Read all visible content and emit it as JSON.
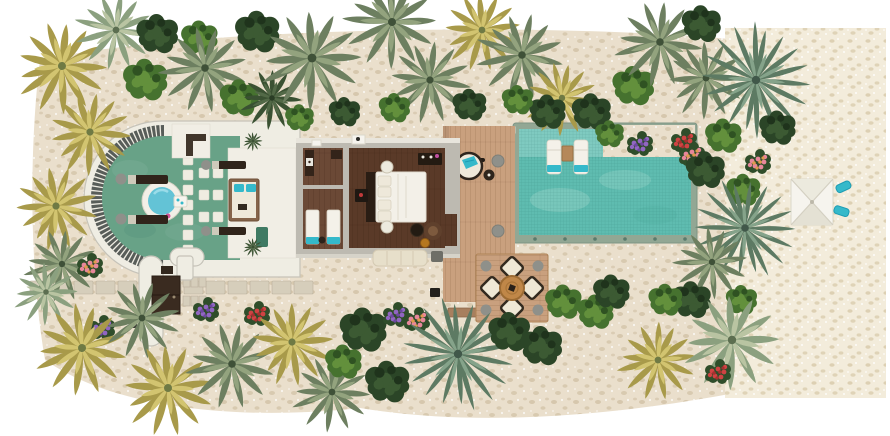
{
  "meta": {
    "view": "villa-floor-plan-top-down",
    "canvas": {
      "width": 890,
      "height": 436
    }
  },
  "colors": {
    "sand": "#eadfcc",
    "beach": "#f3ecdb",
    "paver": "#d6cebb",
    "paverLine": "#b9b09b",
    "wallWhite": "#efede3",
    "wallGray": "#bdbab1",
    "wallLine": "#c6c3b9",
    "floorWhite": "#f1eee5",
    "stoneWhite": "#efece1",
    "slat": "#585d59",
    "pond": "#68a287",
    "jacuzzi": "#63c3d6",
    "jacuzziRim": "#f2efe7",
    "woodDark": "#5a3a28",
    "woodMid": "#6b4936",
    "deck": "#c9a07e",
    "coping": "#92a794",
    "poolMain": "#5fbcb0",
    "poolShelf": "#7fcac0",
    "teal": "#35b9ca",
    "loungerWhite": "#f4f1e9",
    "cream": "#efe8d5",
    "darkFurn": "#241b12",
    "brown": "#5f402c",
    "amber": "#b5771f",
    "red": "#c03a3a",
    "gray": "#8f908a",
    "white": "#f6f4ee"
  },
  "scene": {
    "variants": {
      "palm": {
        "kind": "star",
        "outer": 12,
        "inner": 8,
        "rOuter": 46,
        "rInner": 29,
        "wOuter": 4.6,
        "wInner": 3.4,
        "colors": [
          "#6d7f60",
          "#93a37e",
          "#3f5138"
        ]
      },
      "palmLight": {
        "kind": "star",
        "outer": 12,
        "inner": 8,
        "rOuter": 46,
        "rInner": 29,
        "wOuter": 4.6,
        "wInner": 3.4,
        "colors": [
          "#8ba07f",
          "#b9c4a2",
          "#5c6e50"
        ]
      },
      "palmGold": {
        "kind": "star",
        "outer": 13,
        "inner": 9,
        "rOuter": 46,
        "rInner": 28,
        "wOuter": 4.8,
        "wInner": 3.4,
        "colors": [
          "#a89a4a",
          "#d2c470",
          "#6f7a44"
        ]
      },
      "palmDark": {
        "kind": "star",
        "outer": 12,
        "inner": 8,
        "rOuter": 44,
        "rInner": 27,
        "wOuter": 4.6,
        "wInner": 3.2,
        "colors": [
          "#3a5132",
          "#526947",
          "#2a3d25"
        ]
      },
      "fan": {
        "kind": "star",
        "outer": 18,
        "inner": 10,
        "rOuter": 52,
        "rInner": 30,
        "wOuter": 3.2,
        "wInner": 2.4,
        "colors": [
          "#5d7a63",
          "#85a38a",
          "#41584a"
        ]
      },
      "bush": {
        "kind": "cluster",
        "colors": [
          "#46722f",
          "#63903c",
          "#2f5222"
        ]
      },
      "bushDark": {
        "kind": "cluster",
        "colors": [
          "#2b4527",
          "#3c5a33",
          "#1f331c"
        ]
      },
      "flowerPink": {
        "kind": "flower",
        "colors": [
          "#2f4d2a",
          "#e27b9e",
          "#c75680"
        ]
      },
      "flowerPurple": {
        "kind": "flower",
        "colors": [
          "#2f4d2a",
          "#9166c2",
          "#6d47a1"
        ]
      },
      "flowerRed": {
        "kind": "flower",
        "colors": [
          "#2f4d2a",
          "#cf4343",
          "#a62f2f"
        ]
      },
      "flowerRose": {
        "kind": "flower",
        "colors": [
          "#2f4d2a",
          "#e8879b",
          "#e09a4e"
        ]
      }
    },
    "foliage": [
      [
        "palmGold",
        62,
        66,
        1,
        10
      ],
      [
        "palmLight",
        116,
        30,
        0.85,
        40
      ],
      [
        "bushDark",
        158,
        34,
        0.8,
        0
      ],
      [
        "palmGold",
        90,
        132,
        0.9,
        -15
      ],
      [
        "bush",
        146,
        80,
        0.85,
        0
      ],
      [
        "bush",
        200,
        38,
        0.7,
        0
      ],
      [
        "palm",
        205,
        68,
        0.95,
        20
      ],
      [
        "bushDark",
        258,
        32,
        0.85,
        0
      ],
      [
        "bush",
        240,
        98,
        0.75,
        0
      ],
      [
        "palmDark",
        272,
        98,
        0.7,
        5
      ],
      [
        "palm",
        312,
        58,
        1.1,
        0
      ],
      [
        "palm",
        392,
        22,
        1,
        30
      ],
      [
        "palm",
        430,
        80,
        0.9,
        -20
      ],
      [
        "palmGold",
        482,
        30,
        0.85,
        0
      ],
      [
        "palm",
        522,
        55,
        0.95,
        45
      ],
      [
        "palmGold",
        562,
        98,
        0.8,
        15
      ],
      [
        "bushDark",
        592,
        112,
        0.75,
        0
      ],
      [
        "bush",
        634,
        86,
        0.8,
        0
      ],
      [
        "palm",
        660,
        42,
        0.95,
        10
      ],
      [
        "bushDark",
        702,
        24,
        0.75,
        0
      ],
      [
        "palm",
        706,
        78,
        0.85,
        -30
      ],
      [
        "fan",
        756,
        80,
        1.05,
        15
      ],
      [
        "bush",
        724,
        136,
        0.7,
        0
      ],
      [
        "bushDark",
        778,
        128,
        0.7,
        0
      ],
      [
        "bush",
        300,
        118,
        0.55,
        0
      ],
      [
        "bushDark",
        345,
        112,
        0.6,
        0
      ],
      [
        "bush",
        395,
        108,
        0.6,
        0
      ],
      [
        "bushDark",
        470,
        105,
        0.65,
        0
      ],
      [
        "bushDark",
        548,
        112,
        0.7,
        0
      ],
      [
        "bush",
        518,
        100,
        0.6,
        0
      ],
      [
        "bush",
        610,
        134,
        0.55,
        0
      ],
      [
        "flowerPurple",
        640,
        144,
        1,
        0
      ],
      [
        "flowerRed",
        684,
        141,
        1,
        0
      ],
      [
        "flowerRose",
        692,
        155,
        1,
        0
      ],
      [
        "bushDark",
        706,
        170,
        0.75,
        0
      ],
      [
        "flowerRose",
        758,
        162,
        1,
        0
      ],
      [
        "bush",
        744,
        190,
        0.65,
        0
      ],
      [
        "fan",
        745,
        228,
        0.95,
        -10
      ],
      [
        "palm",
        712,
        262,
        0.8,
        25
      ],
      [
        "bushDark",
        692,
        300,
        0.75,
        0
      ],
      [
        "bush",
        742,
        300,
        0.6,
        0
      ],
      [
        "palmGold",
        56,
        206,
        0.9,
        -35
      ],
      [
        "palm",
        62,
        264,
        0.8,
        10
      ],
      [
        "flowerRose",
        90,
        266,
        1,
        0
      ],
      [
        "palmLight",
        46,
        292,
        0.7,
        0
      ],
      [
        "flowerPurple",
        102,
        328,
        1,
        0
      ],
      [
        "palmGold",
        82,
        348,
        1,
        20
      ],
      [
        "palm",
        142,
        318,
        0.85,
        -10
      ],
      [
        "palmGold",
        168,
        388,
        1,
        0
      ],
      [
        "flowerPurple",
        206,
        310,
        1,
        0
      ],
      [
        "flowerRed",
        257,
        314,
        1,
        0
      ],
      [
        "palm",
        232,
        364,
        0.95,
        15
      ],
      [
        "palmGold",
        292,
        342,
        0.9,
        -25
      ],
      [
        "palm",
        332,
        392,
        0.85,
        5
      ],
      [
        "bushDark",
        364,
        330,
        0.9,
        0
      ],
      [
        "flowerPurple",
        396,
        315,
        1,
        0
      ],
      [
        "flowerRose",
        417,
        320,
        1,
        0
      ],
      [
        "bushDark",
        388,
        382,
        0.85,
        0
      ],
      [
        "bush",
        344,
        362,
        0.7,
        0
      ],
      [
        "fan",
        458,
        354,
        1.05,
        0
      ],
      [
        "bushDark",
        510,
        332,
        0.8,
        0
      ],
      [
        "bush",
        564,
        302,
        0.7,
        0
      ],
      [
        "bushDark",
        542,
        346,
        0.8,
        0
      ],
      [
        "bush",
        596,
        312,
        0.7,
        0
      ],
      [
        "bushDark",
        612,
        292,
        0.7,
        0
      ],
      [
        "bush",
        666,
        300,
        0.65,
        0
      ],
      [
        "palmGold",
        658,
        360,
        0.85,
        30
      ],
      [
        "palmLight",
        732,
        340,
        1.05,
        0
      ],
      [
        "flowerRed",
        718,
        372,
        1,
        0
      ],
      [
        "palmDark",
        253,
        141,
        0.22,
        0
      ],
      [
        "palmDark",
        253,
        247,
        0.22,
        0
      ]
    ]
  }
}
